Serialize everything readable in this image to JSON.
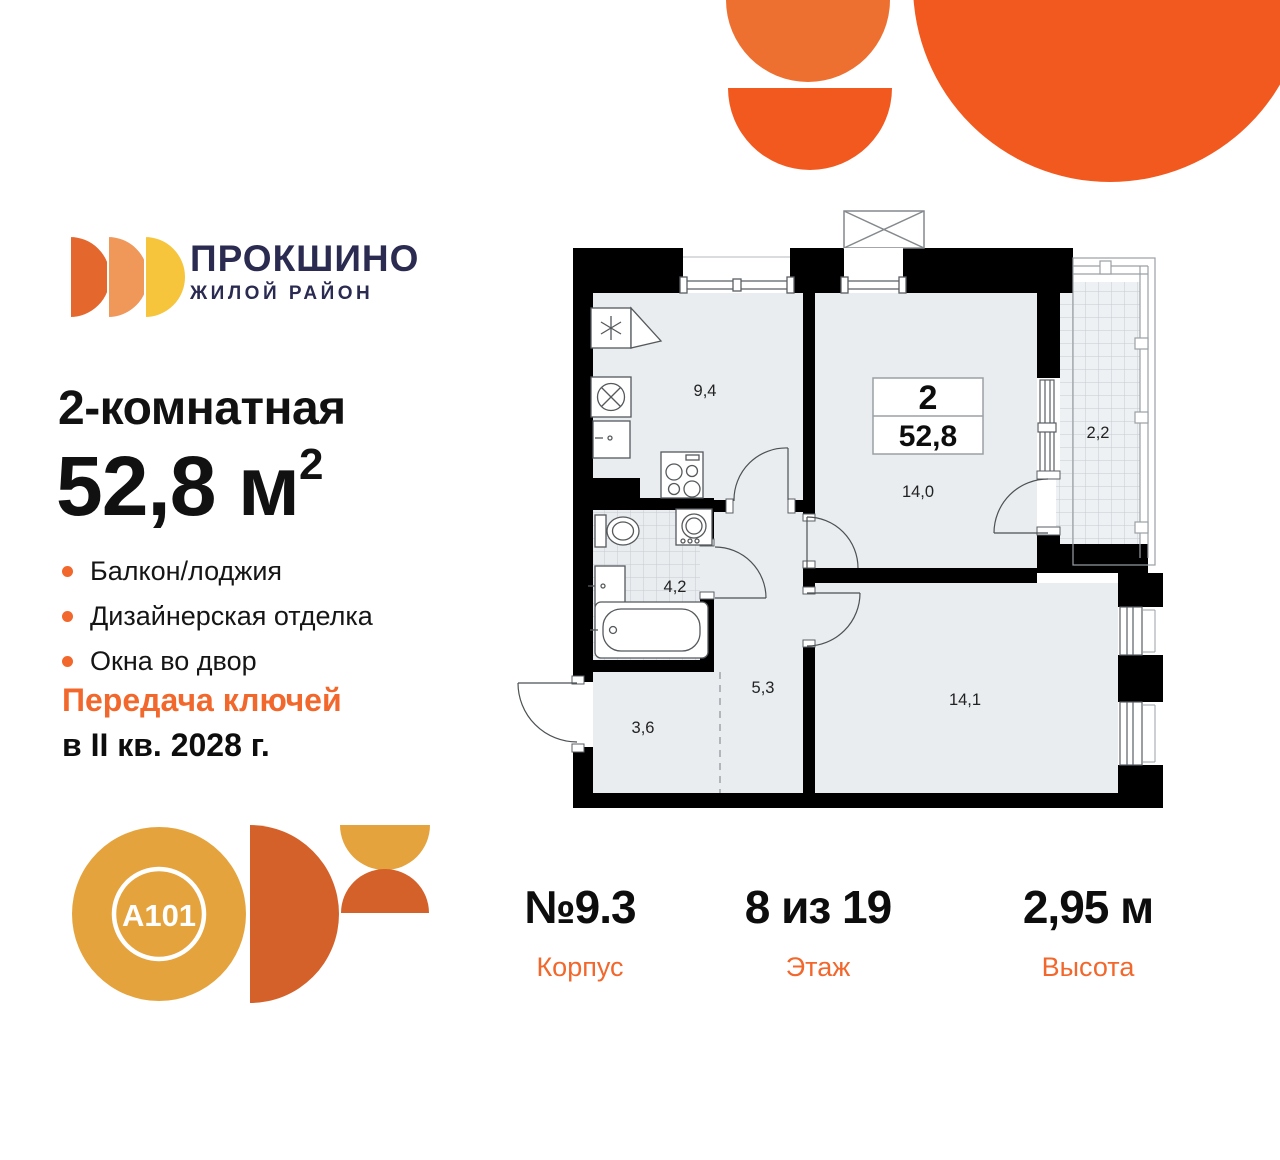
{
  "brand": {
    "name": "ПРОКШИНО",
    "tagline": "ЖИЛОЙ РАЙОН",
    "developer": "A101"
  },
  "palette": {
    "accent_orange": "#f2672b",
    "brand_navy": "#2b2b52",
    "logo_semicircles": [
      "#e4672d",
      "#f0975a",
      "#f6c53c"
    ],
    "deco_orange_light": "#ee7030",
    "deco_orange": "#f2591f",
    "a101_amber": "#e5a33d",
    "a101_rust": "#d5612a",
    "plan_room_fill": "#e9edf0"
  },
  "listing": {
    "title": "2-комнатная",
    "area_value": "52,8",
    "area_unit": "м",
    "area_sup": "2",
    "features": [
      "Балкон/лоджия",
      "Дизайнерская отделка",
      "Окна во двор"
    ],
    "handover_line1": "Передача ключей",
    "handover_line2": "в II кв. 2028 г."
  },
  "plan": {
    "type_number": "2",
    "total_area": "52,8",
    "rooms": [
      {
        "name": "kitchen",
        "area": "9,4"
      },
      {
        "name": "living-room",
        "area": "14,0"
      },
      {
        "name": "balcony",
        "area": "2,2"
      },
      {
        "name": "bathroom",
        "area": "4,2"
      },
      {
        "name": "hallway",
        "area": "5,3"
      },
      {
        "name": "entry",
        "area": "3,6"
      },
      {
        "name": "bedroom",
        "area": "14,1"
      }
    ]
  },
  "stats": [
    {
      "value": "№9.3",
      "label": "Корпус"
    },
    {
      "value": "8 из 19",
      "label": "Этаж"
    },
    {
      "value": "2,95 м",
      "label": "Высота"
    }
  ]
}
